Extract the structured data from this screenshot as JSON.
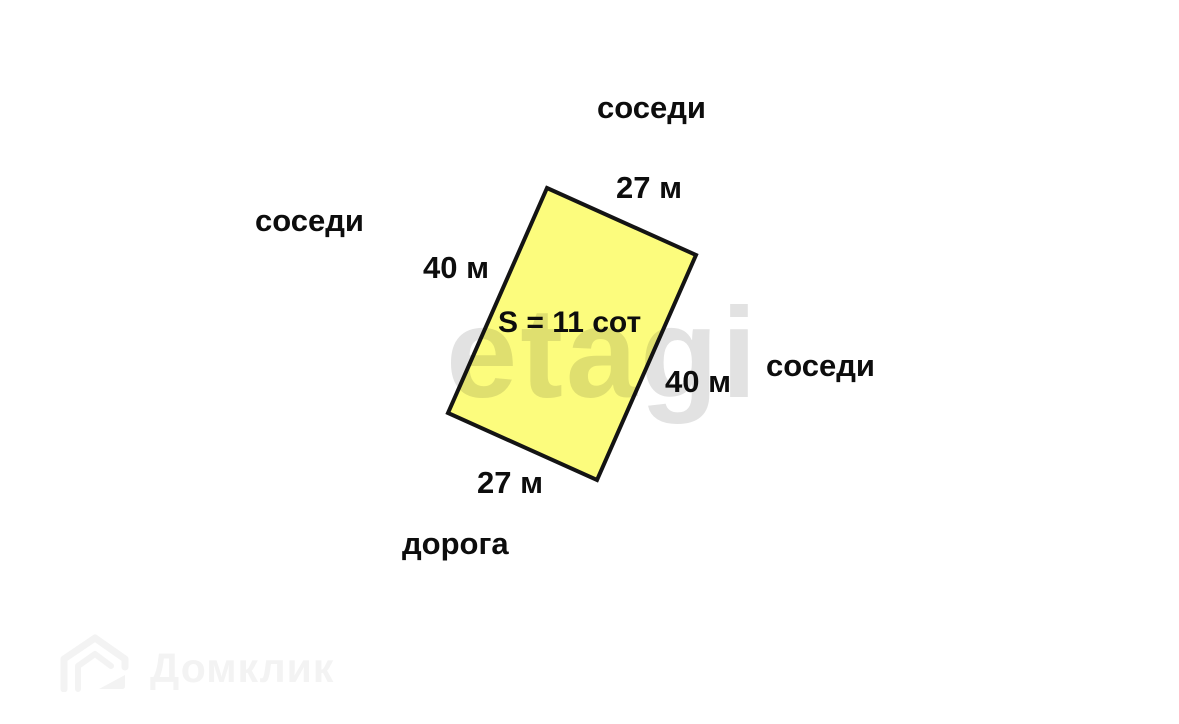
{
  "diagram": {
    "plot": {
      "points": "547,188 696,255 597,480 448,413",
      "fill": "#fcfc7d",
      "stroke": "#141414",
      "stroke_width": "4",
      "area_label": "S = 11 сот"
    },
    "sides": {
      "top_length": "27 м",
      "bottom_length": "27 м",
      "left_length": "40 м",
      "right_length": "40 м"
    },
    "surroundings": {
      "top": "соседи",
      "left": "соседи",
      "right": "соседи",
      "bottom": "дорога"
    },
    "watermark": {
      "text": "etagi",
      "color": "#e2e2e2"
    },
    "logo": {
      "text": "Домклик",
      "color": "#f3f3f3"
    }
  }
}
